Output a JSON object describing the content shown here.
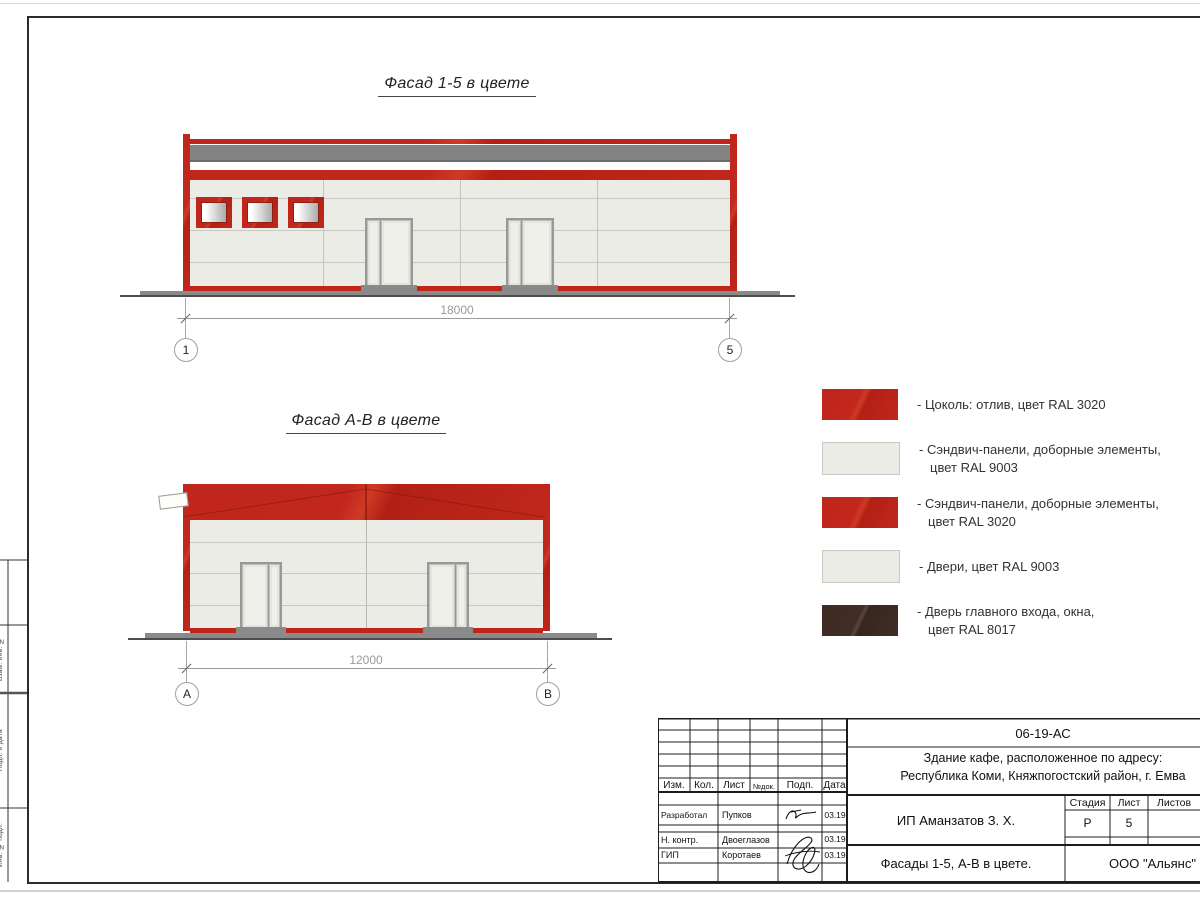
{
  "drawing": {
    "facade_1_5": {
      "title": "Фасад 1-5 в цвете",
      "dimension": "18000",
      "axis_left": "1",
      "axis_right": "5"
    },
    "facade_a_b": {
      "title": "Фасад А-В в цвете",
      "dimension": "12000",
      "axis_left": "А",
      "axis_right": "В"
    }
  },
  "legend": {
    "items": [
      {
        "label": "- Цоколь: отлив, цвет RAL 3020",
        "color_hex": "#c1271c",
        "style": "red"
      },
      {
        "label": "- Сэндвич-панели, доборные элементы,\nцвет RAL 9003",
        "color_hex": "#ecece7",
        "style": "light"
      },
      {
        "label": "- Сэндвич-панели, доборные элементы,\nцвет RAL 3020",
        "color_hex": "#c1271c",
        "style": "red"
      },
      {
        "label": "- Двери, цвет RAL 9003",
        "color_hex": "#ecece7",
        "style": "light"
      },
      {
        "label": "- Дверь главного входа, окна,\nцвет RAL 8017",
        "color_hex": "#402e26",
        "style": "dark"
      }
    ]
  },
  "colors": {
    "ral_3020_red": "#c1271c",
    "ral_9003_white": "#ecece7",
    "ral_8017_brown": "#402e26",
    "roof_band_gray": "#838383"
  },
  "title_block": {
    "doc_number": "06-19-АС",
    "object_line1": "Здание кафе, расположенное по адресу:",
    "object_line2": "Республика Коми, Княжпогостский район, г. Емва",
    "client": "ИП Аманзатов З. Х.",
    "sheet_name": "Фасады 1-5, А-В в цвете.",
    "company": "ООО \"Альянс\"",
    "header_cols": {
      "izm": "Изм.",
      "kol": "Кол.",
      "list": "Лист",
      "doc_no": "№док.",
      "sign": "Подп.",
      "date": "Дата"
    },
    "signers": [
      {
        "role": "Разработал",
        "name": "Пупков",
        "date": "03.19"
      },
      {
        "role": "Н. контр.",
        "name": "Двоеглазов",
        "date": "03.19"
      },
      {
        "role": "ГИП",
        "name": "Коротаев",
        "date": "03.19"
      }
    ],
    "stage_cols": {
      "stage": "Стадия",
      "sheet": "Лист",
      "sheets": "Листов"
    },
    "stage_value": "Р",
    "sheet_value": "5"
  },
  "side_column": {
    "labels": [
      "Взам. инв. №",
      "Подп. и дата",
      "Инв. № подл."
    ]
  }
}
